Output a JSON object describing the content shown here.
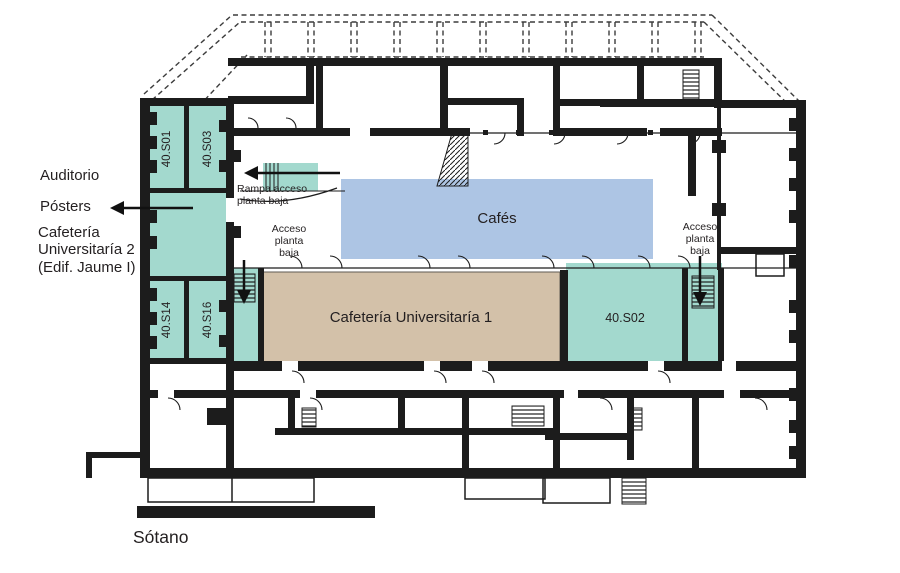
{
  "colors": {
    "room_teal": "#a3d9ce",
    "cafes_blue": "#adc5e4",
    "cafeteria_tan": "#d3c1a9",
    "wall": "#1c1c1c"
  },
  "side_labels": {
    "auditorio": "Auditorio",
    "posters": "Pósters",
    "cafeteria_universitaria_2": "Cafetería\nUniversitaría 2\n(Edif. Jaume I)"
  },
  "rooms": {
    "s01": "40.S01",
    "s03": "40.S03",
    "s14": "40.S14",
    "s16": "40.S16",
    "s02": "40.S02",
    "cafes": "Cafés",
    "cafeteria_universitaria_1": "Cafetería Universitaría 1"
  },
  "annotations": {
    "rampa_acceso": "Rampa acceso\nplanta baja",
    "acceso_left": "Acceso\nplanta\nbaja",
    "acceso_right": "Acceso\nplanta\nbaja"
  },
  "floor": {
    "label": "Sótano"
  }
}
